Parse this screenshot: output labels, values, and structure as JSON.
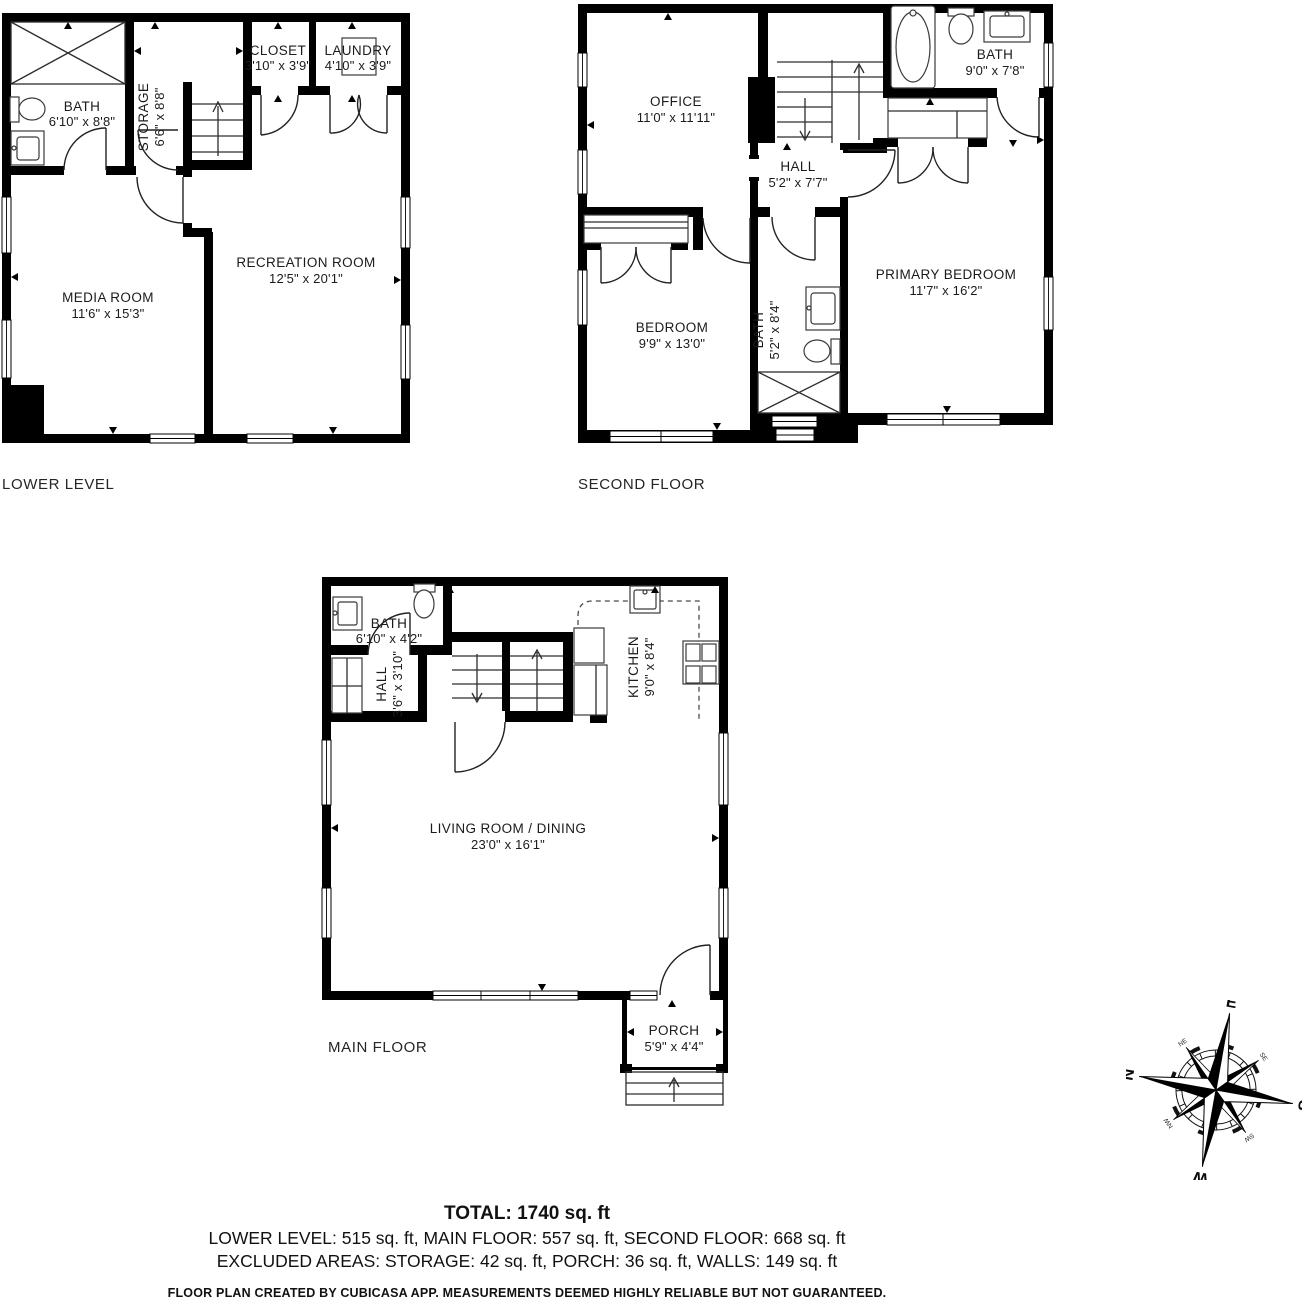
{
  "floors": [
    {
      "id": "lower",
      "label": "LOWER LEVEL",
      "rooms": [
        {
          "name": "BATH",
          "dims": "6'10\" x 8'8\""
        },
        {
          "name": "STORAGE",
          "dims": "6'6\" x 8'8\""
        },
        {
          "name": "CLOSET",
          "dims": "3'10\" x 3'9\""
        },
        {
          "name": "LAUNDRY",
          "dims": "4'10\" x 3'9\""
        },
        {
          "name": "MEDIA ROOM",
          "dims": "11'6\" x 15'3\""
        },
        {
          "name": "RECREATION ROOM",
          "dims": "12'5\" x 20'1\""
        }
      ]
    },
    {
      "id": "second",
      "label": "SECOND FLOOR",
      "rooms": [
        {
          "name": "OFFICE",
          "dims": "11'0\" x 11'11\""
        },
        {
          "name": "BATH",
          "dims": "9'0\" x 7'8\""
        },
        {
          "name": "HALL",
          "dims": "5'2\" x 7'7\""
        },
        {
          "name": "BEDROOM",
          "dims": "9'9\" x 13'0\""
        },
        {
          "name": "BATH",
          "dims": "5'2\" x 8'4\""
        },
        {
          "name": "PRIMARY BEDROOM",
          "dims": "11'7\" x 16'2\""
        }
      ]
    },
    {
      "id": "main",
      "label": "MAIN FLOOR",
      "rooms": [
        {
          "name": "BATH",
          "dims": "6'10\" x 4'2\""
        },
        {
          "name": "HALL",
          "dims": "3'6\" x 3'10\""
        },
        {
          "name": "KITCHEN",
          "dims": "9'0\" x 8'4\""
        },
        {
          "name": "LIVING ROOM / DINING",
          "dims": "23'0\" x 16'1\""
        },
        {
          "name": "PORCH",
          "dims": "5'9\" x 4'4\""
        }
      ]
    }
  ],
  "compass": {
    "n": "N",
    "e": "E",
    "s": "S",
    "w": "W",
    "ne": "NE",
    "se": "SE",
    "sw": "SW",
    "nw": "NW"
  },
  "summary": {
    "total": "TOTAL: 1740 sq. ft",
    "floor_areas": "LOWER LEVEL: 515 sq. ft, MAIN FLOOR: 557 sq. ft, SECOND FLOOR: 668 sq. ft",
    "excluded": "EXCLUDED AREAS: STORAGE: 42 sq. ft, PORCH: 36 sq. ft, WALLS: 149 sq. ft",
    "disclaimer": "FLOOR PLAN CREATED BY CUBICASA APP. MEASUREMENTS DEEMED HIGHLY RELIABLE BUT NOT GUARANTEED."
  },
  "colors": {
    "wall": "#000000",
    "text": "#1b1b1b",
    "background": "#ffffff"
  }
}
